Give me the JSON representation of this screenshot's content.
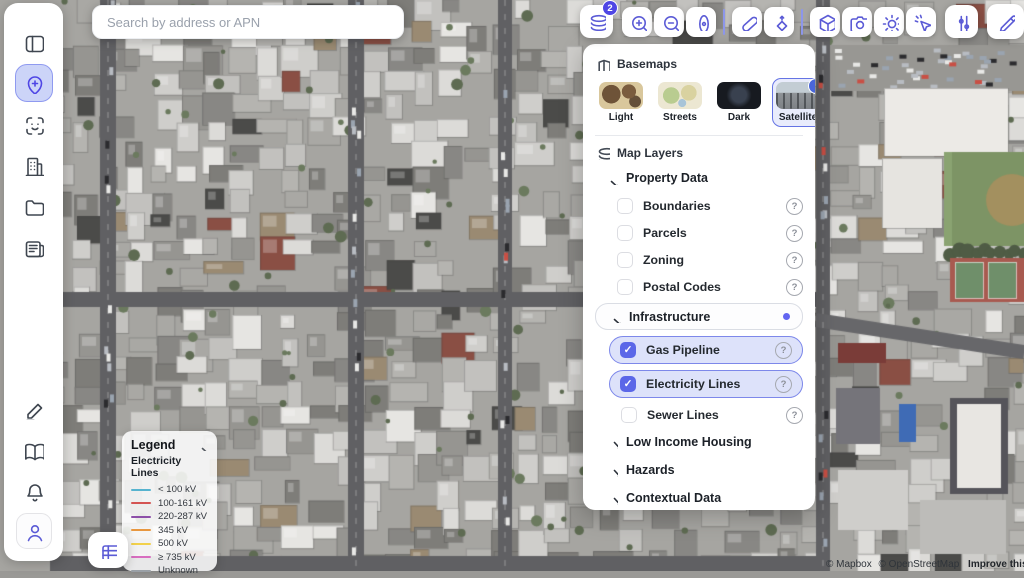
{
  "search": {
    "placeholder": "Search by address or APN"
  },
  "sidebar": {
    "top_items": [
      {
        "id": "sidebar-toggle",
        "icon": "panel-left-icon"
      },
      {
        "id": "map-pin",
        "icon": "map-pin-plus-icon",
        "active": true
      },
      {
        "id": "scan",
        "icon": "face-scan-icon"
      },
      {
        "id": "buildings",
        "icon": "building-icon"
      },
      {
        "id": "folders",
        "icon": "folder-icon"
      },
      {
        "id": "reports",
        "icon": "newspaper-icon"
      }
    ],
    "bottom_items": [
      {
        "id": "notes",
        "icon": "pencil-line-icon"
      },
      {
        "id": "library",
        "icon": "book-open-icon"
      },
      {
        "id": "notifications",
        "icon": "bell-icon"
      },
      {
        "id": "account",
        "icon": "user-icon",
        "boxed": true
      }
    ]
  },
  "toolbar": {
    "layers_badge": "2",
    "group_buttons": [
      "zoom-in",
      "zoom-out",
      "location-pin",
      "eraser",
      "navigate-diamond",
      "cube-3d",
      "camera",
      "sun",
      "cursor-click"
    ],
    "right_buttons": [
      "sliders",
      "draw-pencil"
    ]
  },
  "layers_panel": {
    "basemaps": {
      "title": "Basemaps",
      "options": [
        {
          "label": "Light",
          "selected": false
        },
        {
          "label": "Streets",
          "selected": false
        },
        {
          "label": "Dark",
          "selected": false
        },
        {
          "label": "Satellite",
          "selected": true
        }
      ]
    },
    "map_layers": {
      "title": "Map Layers",
      "groups": [
        {
          "label": "Property Data",
          "expanded": true,
          "items": [
            {
              "label": "Boundaries",
              "checked": false
            },
            {
              "label": "Parcels",
              "checked": false
            },
            {
              "label": "Zoning",
              "checked": false
            },
            {
              "label": "Postal Codes",
              "checked": false
            }
          ]
        },
        {
          "label": "Infrastructure",
          "expanded": true,
          "active": true,
          "items": [
            {
              "label": "Gas Pipeline",
              "checked": true
            },
            {
              "label": "Electricity Lines",
              "checked": true
            },
            {
              "label": "Sewer Lines",
              "checked": false
            }
          ]
        },
        {
          "label": "Low Income Housing",
          "expanded": false
        },
        {
          "label": "Hazards",
          "expanded": false
        },
        {
          "label": "Contextual Data",
          "expanded": false
        }
      ]
    }
  },
  "legend": {
    "title": "Legend",
    "subtitle": "Electricity Lines",
    "items": [
      {
        "label": "< 100 kV",
        "color": "#56b3cf"
      },
      {
        "label": "100-161 kV",
        "color": "#d45452"
      },
      {
        "label": "220-287 kV",
        "color": "#8d4fa8"
      },
      {
        "label": "345 kV",
        "color": "#e8973f"
      },
      {
        "label": "500 kV",
        "color": "#f2d14b"
      },
      {
        "label": "≥ 735 kV",
        "color": "#d86ec0"
      },
      {
        "label": "Unknown",
        "color": "#9aa0a6"
      }
    ]
  },
  "attribution": {
    "mapbox": "© Mapbox",
    "osm": "© OpenStreetMap",
    "improve": "Improve this map"
  },
  "colors": {
    "accent": "#5b5bd6",
    "badge": "#4f46e5",
    "selected_fill": "#dde2fa",
    "selected_border": "#7d88ea",
    "active_dot": "#6366f1"
  }
}
